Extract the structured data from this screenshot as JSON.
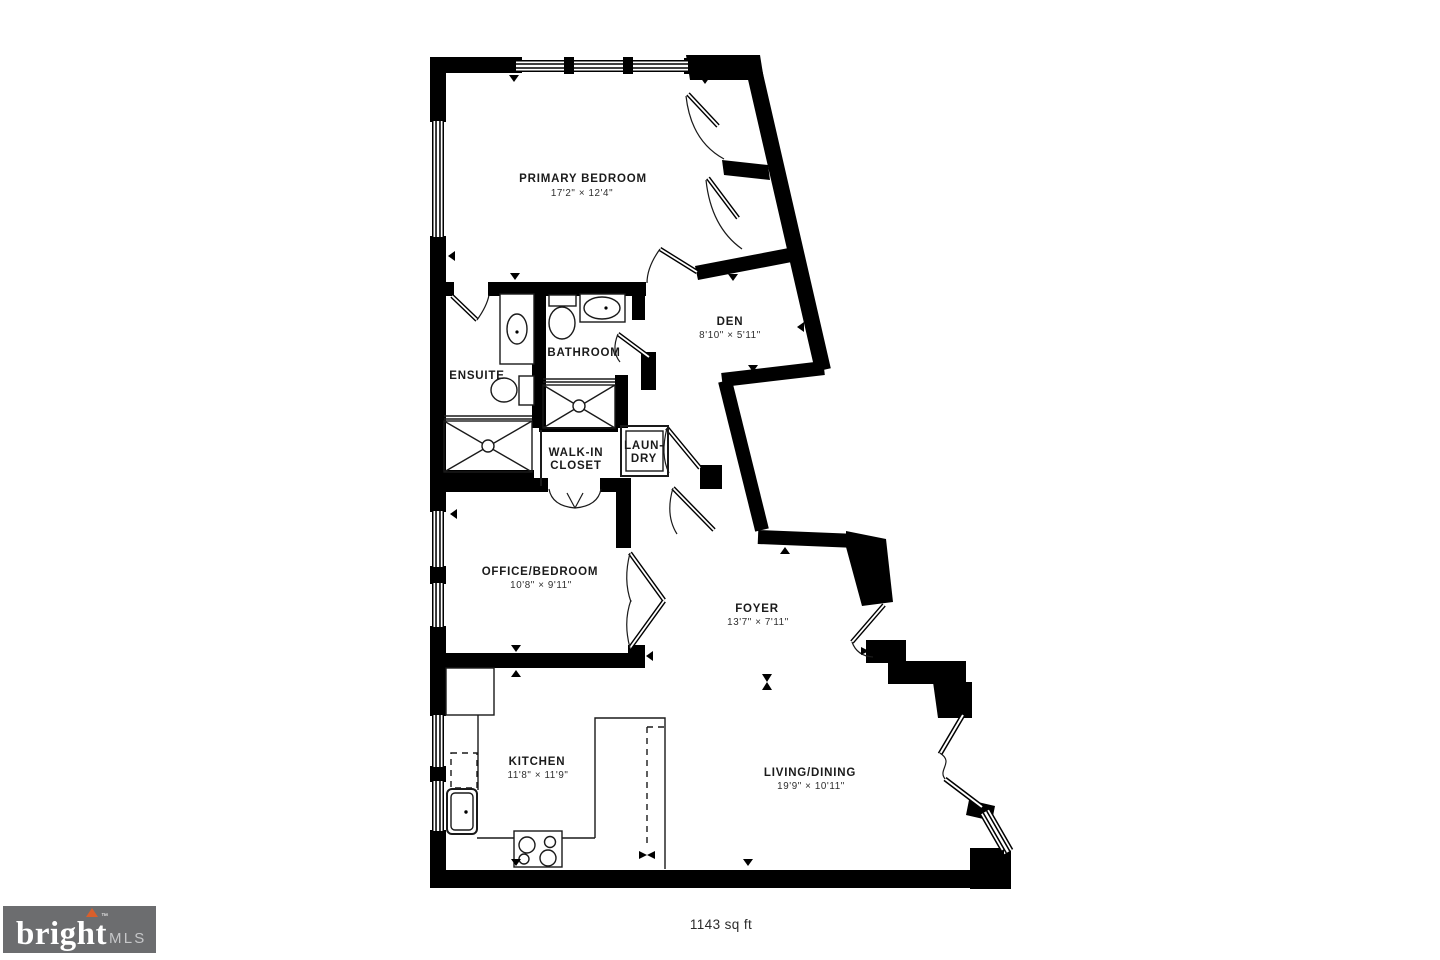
{
  "plan": {
    "area_label": "1143 sq ft",
    "rooms": {
      "primary_bedroom": {
        "name": "PRIMARY BEDROOM",
        "dims": "17'2\" × 12'4\""
      },
      "den": {
        "name": "DEN",
        "dims": "8'10\" × 5'11\""
      },
      "bathroom": {
        "name": "BATHROOM"
      },
      "ensuite": {
        "name": "ENSUITE"
      },
      "walk_in_closet": {
        "line1": "WALK-IN",
        "line2": "CLOSET"
      },
      "laundry": {
        "line1": "LAUN-",
        "line2": "DRY"
      },
      "office_bedroom": {
        "name": "OFFICE/BEDROOM",
        "dims": "10'8\" × 9'11\""
      },
      "foyer": {
        "name": "FOYER",
        "dims": "13'7\" × 7'11\""
      },
      "kitchen": {
        "name": "KITCHEN",
        "dims": "11'8\" × 11'9\""
      },
      "living_dining": {
        "name": "LIVING/DINING",
        "dims": "19'9\" × 10'11\""
      }
    }
  },
  "logo": {
    "brand": "bright",
    "tm": "™",
    "suffix": "MLS"
  },
  "colors": {
    "walls": "#000000",
    "background": "#ffffff",
    "logo_background": "#6c6d6f",
    "logo_text": "#ffffff",
    "logo_accent": "#d95f2b",
    "logo_suffix_text": "#c6c7c9"
  }
}
